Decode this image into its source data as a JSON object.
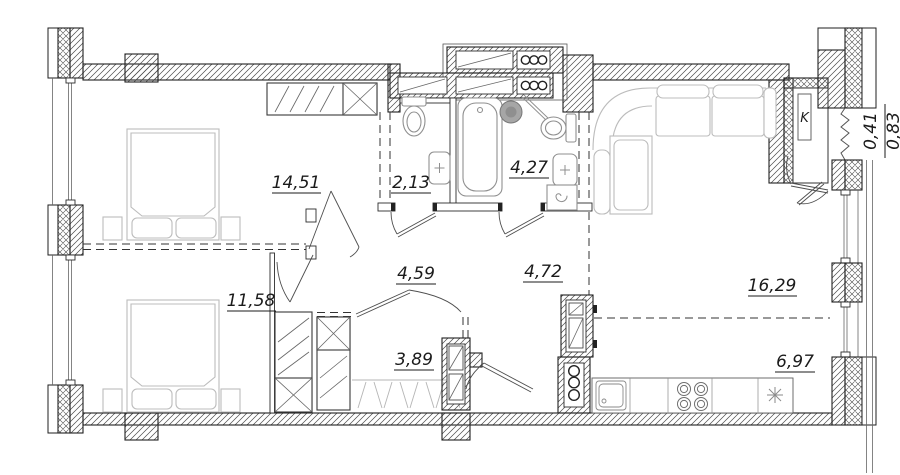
{
  "floorplan": {
    "areas": {
      "bedroom1": "14,51",
      "wc": "2,13",
      "bathroom": "4,27",
      "bedroom2": "11,58",
      "hall1": "4,59",
      "hall2": "4,72",
      "closet": "3,89",
      "living": "16,29",
      "kitchen": "6,97"
    },
    "balcony": {
      "reduced": "0,41",
      "full": "0,83"
    },
    "k_label": "K",
    "colors": {
      "line": "#1f1f1f",
      "furniture": "#bcbcbc",
      "fixture": "#8f8f8f",
      "background": "#ffffff"
    }
  }
}
